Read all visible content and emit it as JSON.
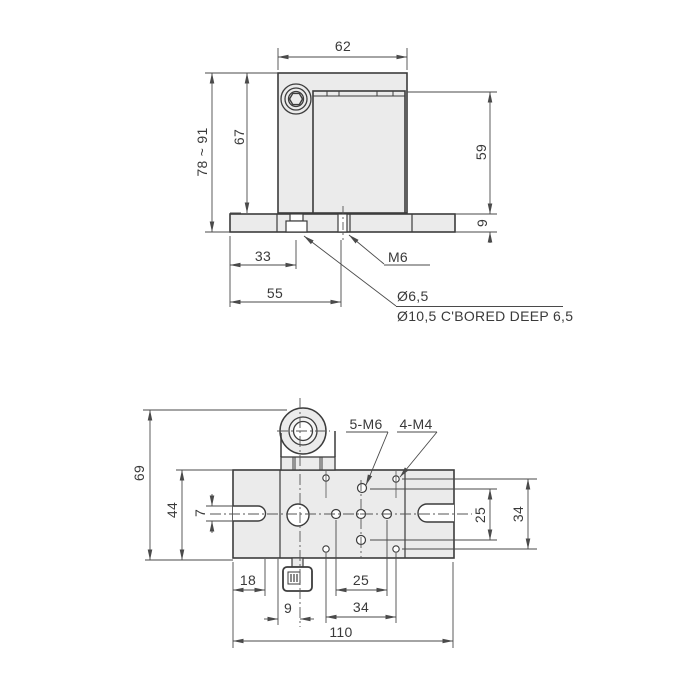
{
  "drawing": {
    "type": "2-view mechanical dimension drawing",
    "colors": {
      "background": "#ffffff",
      "outline": "#3c3c3c",
      "dimension": "#4a4a4a",
      "part_fill": "#ebebeb",
      "hole_fill": "#ffffff"
    },
    "front_view": {
      "labels": {
        "width_top": "62",
        "height_range": "78 ~ 91",
        "height_body": "67",
        "height_right": "59",
        "base_thickness": "9",
        "hole_offset_1": "33",
        "hole_offset_2": "55",
        "thread": "M6",
        "through_hole": "Ø6,5",
        "counterbore": "Ø10,5 C'BORED DEEP 6,5"
      }
    },
    "plan_view": {
      "labels": {
        "total_height": "69",
        "body_height": "44",
        "slot_width": "7",
        "slot_offset": "18",
        "center_offset": "9",
        "pitch_25_bottom": "25",
        "pitch_34_bottom": "34",
        "total_width": "110",
        "pitch_25_right": "25",
        "pitch_34_right": "34",
        "thread_m6": "5-M6",
        "thread_m4": "4-M4"
      }
    }
  }
}
